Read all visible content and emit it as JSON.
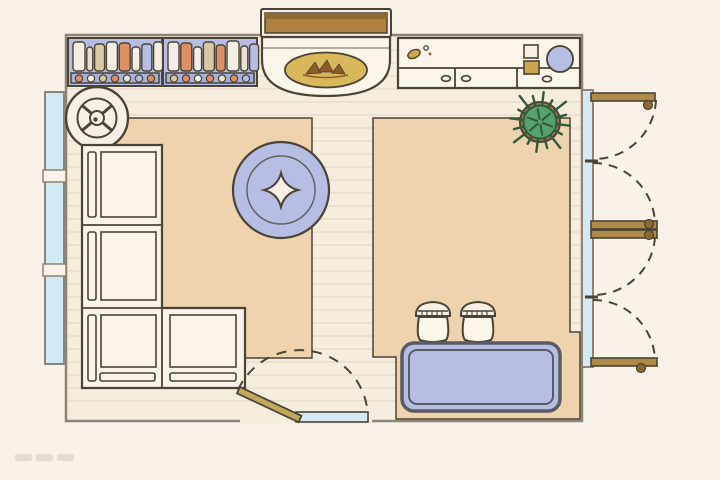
{
  "meta": {
    "description": "Top-down illustrated floor plan of a room (living area with fireplace, bookshelf, sectional sofa, round rug, counter, plant, stools, bench, windows and hinged doors with swing arcs)",
    "canvas_width": 720,
    "canvas_height": 480,
    "watermark_present": true
  },
  "colors": {
    "background": "#f8f2e9",
    "floor": "#f7eddf",
    "plank_line": "#e6d8c4",
    "wall": "#8b8477",
    "ink": "#4a4336",
    "rug": "#eed3ae",
    "periwinkle": "#b6bee3",
    "periwinkle_dark": "#a7b0d7",
    "slate": "#5b5b66",
    "glass": "#d3e9f4",
    "wood": "#b08a49",
    "wood_dark": "#8a6a30",
    "mantel": "#ad7f40",
    "mantel_dark": "#8f6930",
    "gold": "#d8b85b",
    "flame": "#8f5a28",
    "cream": "#f7efe3",
    "white_item": "#fbf5ea",
    "orange": "#df8f63",
    "tan": "#d9c8a6",
    "beige": "#e9e0cf",
    "brass": "#cfa44f",
    "leaf": "#58a06c",
    "leaf_dark": "#2e5c3a",
    "pot": "#ab7158",
    "door_leaf": "#c2a85e"
  },
  "floor": {
    "plank_y0": 50,
    "plank_y1": 413,
    "plank_step": 13,
    "x0": 68,
    "x1": 580
  },
  "bookshelf": {
    "label": "bookshelf-top-view",
    "units": [
      {
        "x": 68,
        "w": 94,
        "books": [
          {
            "c": "#f5eee2",
            "w": 12,
            "h": 29
          },
          {
            "c": "#e9e0cf",
            "w": 6,
            "h": 24
          },
          {
            "c": "#d9c8a6",
            "w": 10,
            "h": 27
          },
          {
            "c": "#f5eee2",
            "w": 11,
            "h": 29
          },
          {
            "c": "#df8f63",
            "w": 11,
            "h": 28
          },
          {
            "c": "#f5eee2",
            "w": 8,
            "h": 24
          },
          {
            "c": "#b6bee3",
            "w": 10,
            "h": 27
          },
          {
            "c": "#f5eee2",
            "w": 9,
            "h": 29
          }
        ],
        "dots": [
          "#df8f63",
          "#f5eee2",
          "#d9c8a6",
          "#df8f63",
          "#e9e0cf",
          "#b6bee3",
          "#df8f63"
        ]
      },
      {
        "x": 163,
        "w": 94,
        "books": [
          {
            "c": "#f5eee2",
            "w": 11,
            "h": 29
          },
          {
            "c": "#df8f63",
            "w": 11,
            "h": 28
          },
          {
            "c": "#f5eee2",
            "w": 8,
            "h": 24
          },
          {
            "c": "#d9c8a6",
            "w": 11,
            "h": 29
          },
          {
            "c": "#df8f63",
            "w": 9,
            "h": 26
          },
          {
            "c": "#f5eee2",
            "w": 12,
            "h": 30
          },
          {
            "c": "#e9e0cf",
            "w": 7,
            "h": 25
          },
          {
            "c": "#b6bee3",
            "w": 9,
            "h": 27
          }
        ],
        "dots": [
          "#d9c8a6",
          "#df8f63",
          "#f5eee2",
          "#df8f63",
          "#e9e0cf",
          "#df8f63",
          "#b6bee3"
        ]
      }
    ]
  },
  "fireplace": {
    "label": "fireplace-with-mantel"
  },
  "counter": {
    "label": "counter-cabinet-with-sink",
    "drawer_handles": 3
  },
  "sofa": {
    "label": "l-shaped-sectional-sofa",
    "sections": 4
  },
  "round_rug": {
    "label": "round-rug-with-star-motif"
  },
  "side_table": {
    "label": "round-side-table-speaker"
  },
  "plant": {
    "label": "potted-plant",
    "spike_count": 16,
    "spike_lengths": [
      30,
      25,
      33,
      27
    ]
  },
  "stools": {
    "label": "spindle-back-stools",
    "count": 2
  },
  "bench": {
    "label": "upholstered-bench"
  },
  "windows": {
    "label": "windows",
    "left": 1,
    "right": 1
  },
  "doors": {
    "label": "hinged-doors-with-swing-arcs",
    "right_wall": 4,
    "entry": 1
  }
}
